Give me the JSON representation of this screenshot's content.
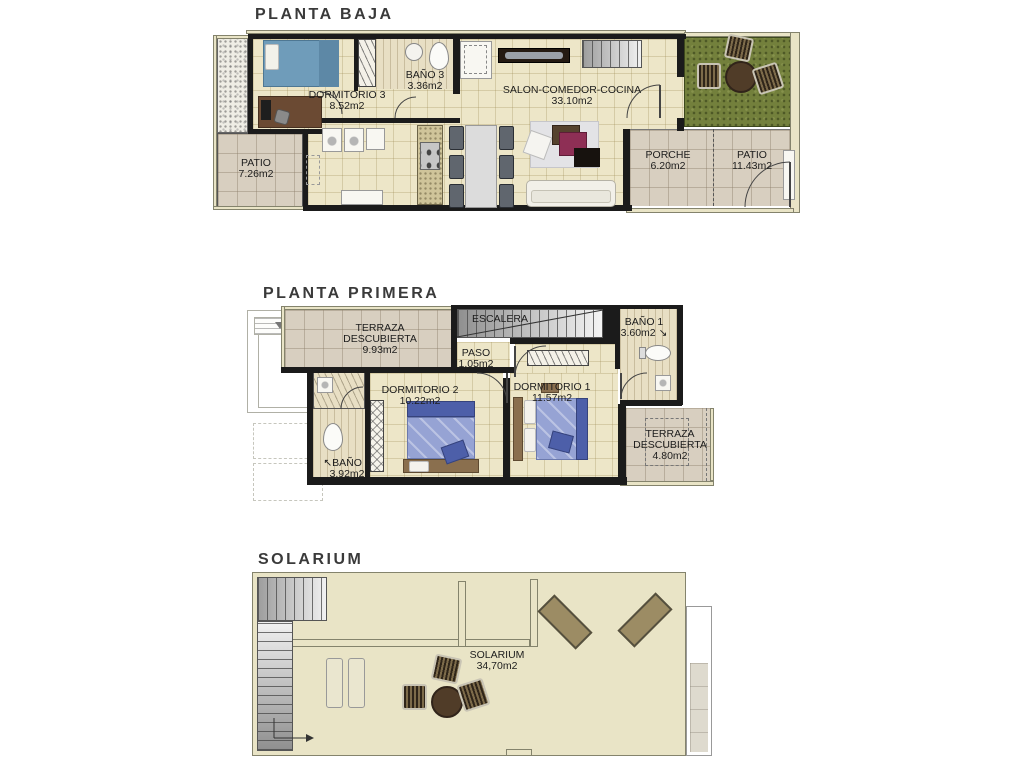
{
  "colors": {
    "wall": "#1b1b1b",
    "floor_cream": "#EDE6C8",
    "tile_taupe": "#D8CFC0",
    "tile_light": "#DEDACE",
    "grass": "#73803C",
    "outer_band": "#E9E4C6",
    "bed_blue_light": "#96A3D4",
    "bed_blue_dark": "#4D5FA9",
    "wood": "#6B4A33"
  },
  "icons": {
    "arrow_up_left": "↖",
    "arrow_down_right": "↘"
  },
  "floors": {
    "baja": {
      "title": "PLANTA BAJA",
      "rooms": {
        "dormitorio3": {
          "name": "DORMITORIO 3",
          "area": "8.52m2"
        },
        "bano3": {
          "name": "BAÑO 3",
          "area": "3.36m2"
        },
        "salon": {
          "name": "SALON-COMEDOR-COCINA",
          "area": "33.10m2"
        },
        "patio_izq": {
          "name": "PATIO",
          "area": "7.26m2"
        },
        "porche": {
          "name": "PORCHE",
          "area": "6.20m2"
        },
        "patio_der": {
          "name": "PATIO",
          "area": "11.43m2"
        }
      }
    },
    "primera": {
      "title": "PLANTA PRIMERA",
      "rooms": {
        "terraza_izq": {
          "name": "TERRAZA",
          "name2": "DESCUBIERTA",
          "area": "9.93m2"
        },
        "escalera": {
          "name": "ESCALERA"
        },
        "paso": {
          "name": "PASO",
          "area": "1.05m2"
        },
        "dormitorio2": {
          "name": "DORMITORIO 2",
          "area": "10.22m2"
        },
        "dormitorio1": {
          "name": "DORMITORIO 1",
          "area": "11.57m2"
        },
        "bano1": {
          "name": "BAÑO 1",
          "area": "3.60m2"
        },
        "bano2": {
          "name": "BAÑO 2",
          "area": "3.92m2"
        },
        "terraza_der": {
          "name": "TERRAZA",
          "name2": "DESCUBIERTA",
          "area": "4.80m2"
        }
      }
    },
    "solarium": {
      "title": "SOLARIUM",
      "rooms": {
        "solarium": {
          "name": "SOLARIUM",
          "area": "34,70m2"
        }
      }
    }
  }
}
